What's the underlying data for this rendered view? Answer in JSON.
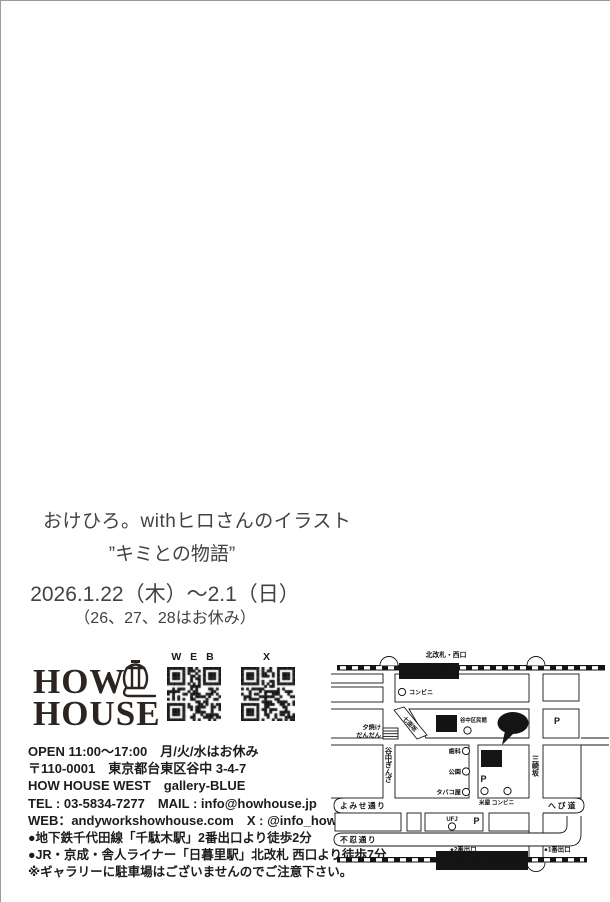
{
  "colors": {
    "ink": "#141414",
    "parking_gray": "#b5b5b5",
    "page_border": "#9b9b9b"
  },
  "intro": {
    "title": "おけひろ。withヒロさんのイラスト",
    "subtitle": "”キミとの物語”",
    "dates": "2026.1.22（木）～2.1（日）",
    "closed_note": "（26、27、28はお休み）"
  },
  "brand": {
    "logo_line1": "HOW",
    "logo_line2": "HOUSE",
    "qr_web_label": "W E B",
    "qr_x_label": "X"
  },
  "contact": {
    "lines": [
      "OPEN 11:00～17:00　月/火/水はお休み",
      "〒110-0001　東京都台東区谷中 3-4-7",
      "HOW HOUSE WEST　gallery-BLUE",
      "TEL : 03-5834-7277　MAIL : info@howhouse.jp",
      "WEB：andyworkshowhouse.com　X : @info_how"
    ]
  },
  "access": {
    "lines": [
      "●地下鉄千代田線「千駄木駅」2番出口より徒歩2分",
      "●JR・京成・舎人ライナー「日暮里駅」北改札 西口より徒歩7分",
      "※ギャラリーに駐車場はございませんのでご注意下さい。"
    ]
  },
  "map": {
    "top_exit_label": "北改札・西口",
    "station_top": "JR 日暮里駅",
    "station_bottom": "千代田線 千駄木駅",
    "exit2": "●2番出口",
    "exit1": "●1番出口",
    "east": "EAST",
    "west": "WEST",
    "here": "Here!",
    "kuminkan": "谷中区民館",
    "conbini_top": "コンビニ",
    "dental": "歯科",
    "park": "公園",
    "tobacco": "タバコ屋",
    "komeya_conbini": "米屋 コンビニ",
    "ufj": "UFJ",
    "yuyake_line1": "夕焼け",
    "yuyake_line2": "だんだん",
    "shichimenzaka": "七面坂",
    "yanaka_ginza": "谷中ぎんざ",
    "misakizaka": "三崎坂",
    "yomise_dori": "よみせ通り",
    "hebimichi": "へび道",
    "shinobazu_dori": "不忍通り",
    "parking": "P"
  }
}
